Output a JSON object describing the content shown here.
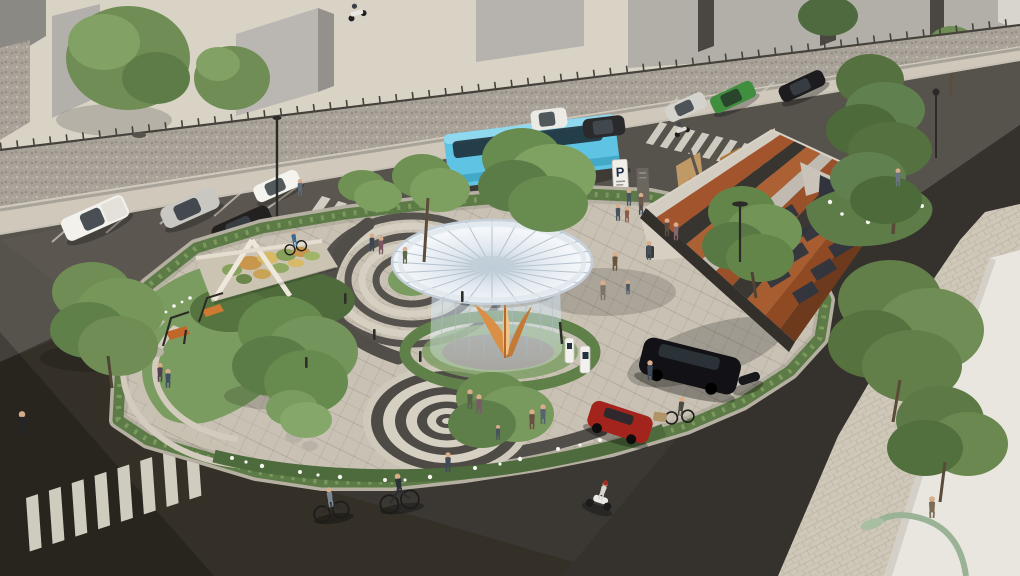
{
  "meta": {
    "type": "3d-architectural-render",
    "view": "aerial-perspective",
    "description": "Aerial render of an urban pocket park: white funnel canopy pavilion with glass base, corten-steel angular shelter with murals and solar panels, dragon-mosaic monument, concentric-circle paving, hedged island surrounded by roads with parked cars, a blue coach bus, crosswalks, cyclists, scooters and pedestrians"
  },
  "signs": {
    "parking_pylon_label": "P"
  },
  "palette": {
    "asphalt": "#3b3834",
    "asphalt_light": "#56524c",
    "asphalt_dark": "#33302b",
    "sidewalk": "#d7d1c3",
    "paving": "#c9c2b4",
    "path_dark": "#514e49",
    "grass": "#7b9c60",
    "hedge": "#5c7b46",
    "tree_green": "#678a4f",
    "pine_green": "#55713f",
    "canopy_white": "#eef2f6",
    "glass_blue": "#cfe0ec",
    "petal_orange": "#d98f45",
    "corten_rust": "#a2552c",
    "roof_charcoal": "#383430",
    "bus_cyan": "#5fc4e4",
    "building_gray": "#b5b2ad",
    "pebble_wall": "#a8a298",
    "red_car": "#a3241c",
    "black_van": "#121216",
    "green_suv": "#3f8f3f",
    "white_vehicle": "#f2f1ec",
    "bench_orange": "#c96f2e",
    "flower_white": "#f6f5ef",
    "lamp_green": "#9ab396"
  },
  "objects": {
    "vehicles": [
      "blue coach bus",
      "white pickup",
      "silver sedan",
      "dark sedan",
      "white coupe",
      "white van",
      "dark suv",
      "silver wagon",
      "green suv",
      "black sedan",
      "black minivan at ev charger",
      "red hatchback",
      "white scooter",
      "moped",
      "two bicycles",
      "cargo tricycle"
    ],
    "park_features": [
      "funnel canopy pavilion",
      "glass cylinder base",
      "orange petal column",
      "corten shelter with murals",
      "solar panel strips",
      "dragon mosaic monument",
      "swing benches",
      "concentric ring plaza",
      "ring path around lawn",
      "curved steps",
      "ev charging stations",
      "white flower beds",
      "boulders",
      "hedge border",
      "street lamps",
      "bollards",
      "parking pylon sign",
      "wayfinding totem",
      "memorial plaque"
    ],
    "context": [
      "gray buildings",
      "pebble retaining wall with fence",
      "zebra crosswalks x3",
      "parking stalls",
      "white corner building",
      "paver sidewalk",
      "pedestrians",
      "cyclists"
    ]
  }
}
